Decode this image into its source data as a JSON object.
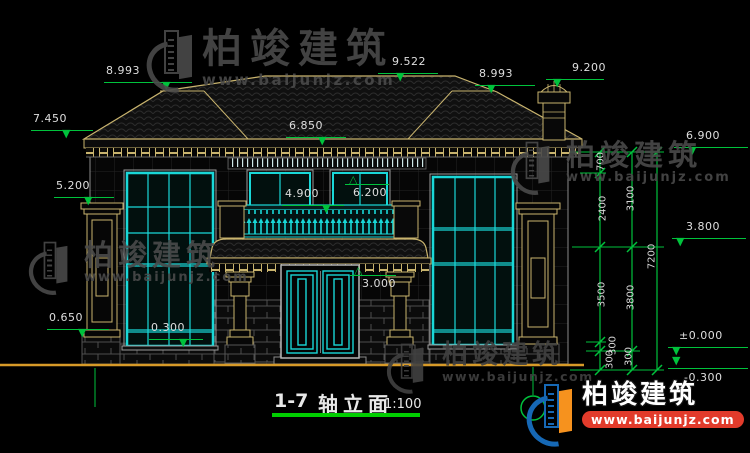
{
  "title": {
    "drawing_no": "1-7",
    "name": "轴立面",
    "scale": "1:100"
  },
  "watermark": {
    "brand": "柏竣建筑",
    "url": "www.baijunjz.com"
  },
  "levels": [
    {
      "text": "8.993",
      "tx": 106,
      "ty": 64,
      "lx": 104,
      "ly": 82,
      "lw": 88,
      "g": "▼",
      "gx": 162,
      "gy": 80
    },
    {
      "text": "9.522",
      "tx": 392,
      "ty": 55,
      "lx": 378,
      "ly": 73,
      "lw": 60,
      "g": "▼",
      "gx": 396,
      "gy": 71
    },
    {
      "text": "8.993",
      "tx": 479,
      "ty": 67,
      "lx": 475,
      "ly": 85,
      "lw": 60,
      "g": "▼",
      "gx": 487,
      "gy": 83
    },
    {
      "text": "9.200",
      "tx": 572,
      "ty": 61,
      "lx": 546,
      "ly": 79,
      "lw": 58,
      "g": "▼",
      "gx": 553,
      "gy": 77
    },
    {
      "text": "7.450",
      "tx": 33,
      "ty": 112,
      "lx": 31,
      "ly": 130,
      "lw": 62,
      "g": "▼",
      "gx": 62,
      "gy": 128
    },
    {
      "text": "5.200",
      "tx": 56,
      "ty": 179,
      "lx": 54,
      "ly": 197,
      "lw": 60,
      "g": "▼",
      "gx": 84,
      "gy": 195
    },
    {
      "text": "0.650",
      "tx": 49,
      "ty": 311,
      "lx": 47,
      "ly": 329,
      "lw": 62,
      "g": "▼",
      "gx": 78,
      "gy": 327
    },
    {
      "text": "6.850",
      "tx": 289,
      "ty": 119,
      "lx": 286,
      "ly": 137,
      "lw": 60,
      "g": "▼",
      "gx": 318,
      "gy": 135
    },
    {
      "text": "4.900",
      "tx": 285,
      "ty": 187,
      "lx": 282,
      "ly": 205,
      "lw": 62,
      "g": "▼",
      "gx": 322,
      "gy": 203
    },
    {
      "text": "6.200",
      "tx": 353,
      "ty": 186,
      "lx": 345,
      "ly": 184,
      "lw": 44,
      "g": "△",
      "gx": 349,
      "gy": 174
    },
    {
      "text": "3.000",
      "tx": 362,
      "ty": 277,
      "lx": 350,
      "ly": 275,
      "lw": 46,
      "g": "△",
      "gx": 354,
      "gy": 265
    },
    {
      "text": "0.300",
      "tx": 151,
      "ty": 321,
      "lx": 149,
      "ly": 339,
      "lw": 54,
      "g": "▼",
      "gx": 179,
      "gy": 337
    },
    {
      "text": "6.900",
      "tx": 686,
      "ty": 129,
      "lx": 674,
      "ly": 147,
      "lw": 74,
      "g": "▼",
      "gx": 688,
      "gy": 145
    },
    {
      "text": "3.800",
      "tx": 686,
      "ty": 220,
      "lx": 672,
      "ly": 238,
      "lw": 74,
      "g": "▼",
      "gx": 676,
      "gy": 236
    },
    {
      "text": "±0.000",
      "tx": 679,
      "ty": 329,
      "lx": 668,
      "ly": 347,
      "lw": 80,
      "g": "▼",
      "gx": 672,
      "gy": 345
    },
    {
      "text": "-0.300",
      "tx": 684,
      "ty": 371,
      "lx": 668,
      "ly": 368,
      "lw": 80,
      "g": "▼",
      "gx": 672,
      "gy": 355
    }
  ],
  "vdims": {
    "labels": [
      {
        "text": "700",
        "x": 601,
        "y": 163
      },
      {
        "text": "2400",
        "x": 603,
        "y": 210
      },
      {
        "text": "3500",
        "x": 602,
        "y": 296
      },
      {
        "text": "300",
        "x": 613,
        "y": 347
      },
      {
        "text": "300",
        "x": 610,
        "y": 361
      },
      {
        "text": "3100",
        "x": 631,
        "y": 200
      },
      {
        "text": "3800",
        "x": 631,
        "y": 299
      },
      {
        "text": "300",
        "x": 629,
        "y": 358
      },
      {
        "text": "7200",
        "x": 652,
        "y": 258
      }
    ]
  },
  "colors": {
    "dimension_green": "#00C23C",
    "trim_tan": "#C9B46E",
    "frame_cyan": "#19D8D8",
    "ground_orange": "#D79A28",
    "logo_blue": "#1668B5",
    "logo_orange": "#F6921E",
    "banner_red": "#E23B2B"
  }
}
